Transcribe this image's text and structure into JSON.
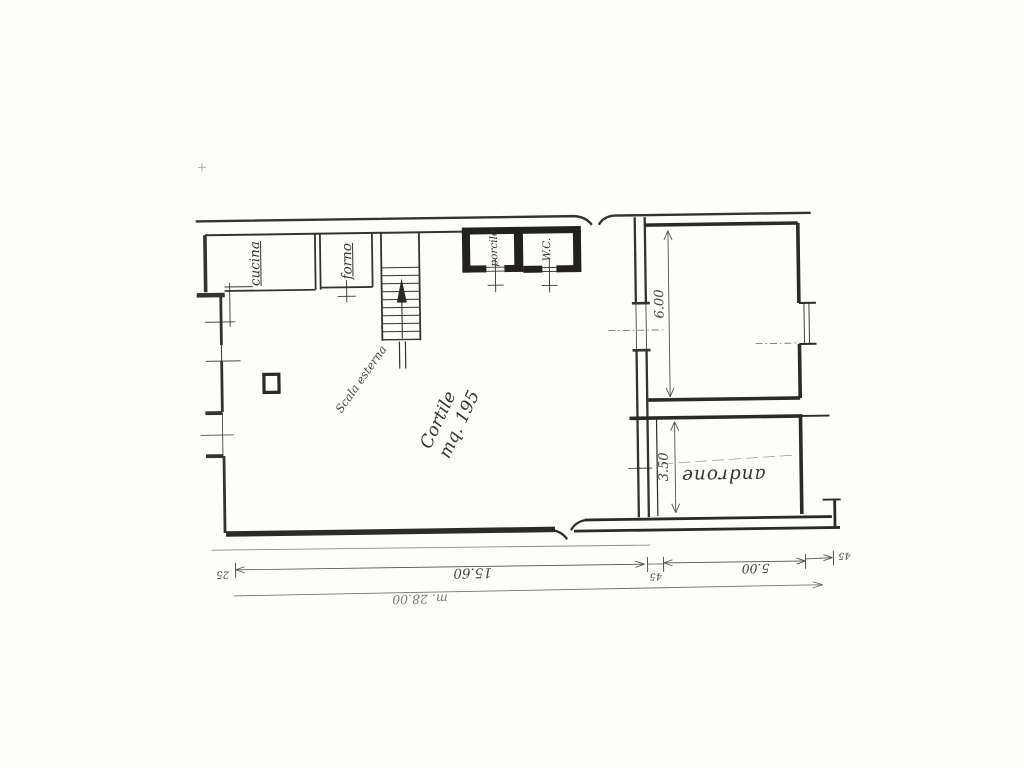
{
  "plan": {
    "labels": {
      "cucina": "cucina",
      "forno": "forno",
      "porcile": "porcile",
      "wc": "W.C.",
      "scala_esterna": "Scala esterna",
      "cortile": "Cortile",
      "cortile_area": "mq. 195",
      "androne": "androne"
    },
    "dimensions": {
      "room_height": "6.00",
      "androne_height": "3.50",
      "cortile_width": "15.60",
      "left_wall_thickness": "25",
      "mid_wall_thickness": "45",
      "androne_span": "5.00",
      "right_wall_thickness": "45",
      "overall_width": "m. 28.00"
    },
    "colors": {
      "ink": "#35332e",
      "wall_fill": "#23211d",
      "dim_ink": "#55524a",
      "paper": "#fdfdfb"
    }
  }
}
